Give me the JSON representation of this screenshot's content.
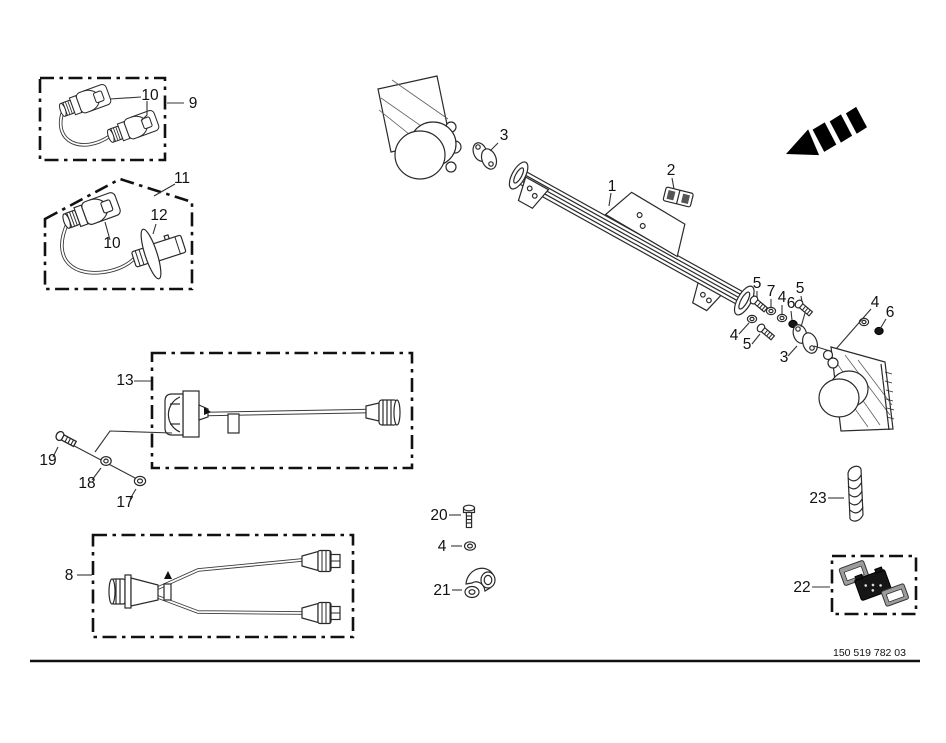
{
  "figure": {
    "type": "exploded-parts-diagram",
    "part_number": "150 519 782 03",
    "line_color": "#1a1a1a",
    "background": "#ffffff"
  },
  "icons": {
    "direction_arrow_icon": "solid black segmented arrow pointing lower-left"
  },
  "callouts": {
    "n1": "1",
    "n2": "2",
    "n3": "3",
    "n4": "4",
    "n5": "5",
    "n6": "6",
    "n7": "7",
    "n8": "8",
    "n9": "9",
    "n10": "10",
    "n11": "11",
    "n12": "12",
    "n13": "13",
    "n17": "17",
    "n18": "18",
    "n19": "19",
    "n20": "20",
    "n21": "21",
    "n22": "22",
    "n23": "23"
  }
}
